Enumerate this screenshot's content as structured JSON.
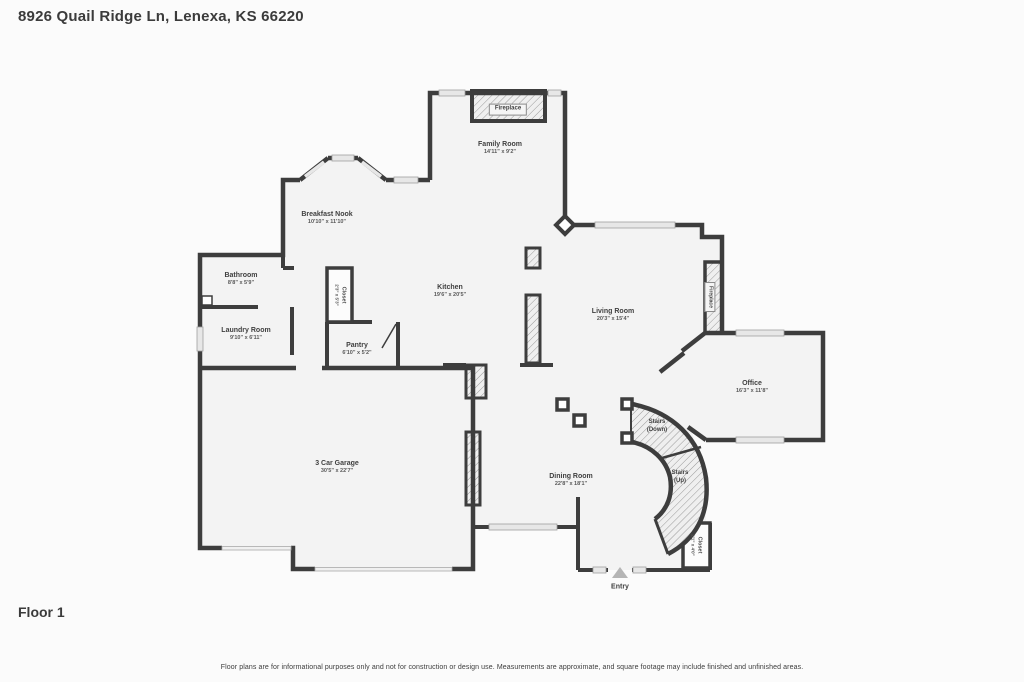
{
  "page": {
    "title": "8926 Quail Ridge Ln, Lenexa, KS 66220",
    "floor_label": "Floor 1",
    "disclaimer": "Floor plans are for informational purposes only and not for construction or design use. Measurements are approximate, and square footage may include finished and unfinished areas."
  },
  "colors": {
    "wall": "#3d3d3d",
    "room_fill": "#f3f3f3",
    "window_fill": "#e7e7e7",
    "background": "#fbfbfb"
  },
  "rooms": {
    "family_room": {
      "name": "Family Room",
      "dims": "14'11\" x 9'2\""
    },
    "breakfast_nook": {
      "name": "Breakfast Nook",
      "dims": "10'10\" x 11'10\""
    },
    "bathroom": {
      "name": "Bathroom",
      "dims": "8'8\" x 5'9\""
    },
    "laundry_room": {
      "name": "Laundry Room",
      "dims": "9'10\" x 6'11\""
    },
    "closet_kitchen": {
      "name": "Closet",
      "dims": "2'3\" x 5'3\""
    },
    "pantry": {
      "name": "Pantry",
      "dims": "6'10\" x 5'2\""
    },
    "kitchen": {
      "name": "Kitchen",
      "dims": "19'6\" x 20'5\""
    },
    "living_room": {
      "name": "Living Room",
      "dims": "20'3\" x 15'4\""
    },
    "office": {
      "name": "Office",
      "dims": "16'3\" x 11'8\""
    },
    "stairs_down": {
      "name": "Stairs",
      "sub": "(Down)"
    },
    "stairs_up": {
      "name": "Stairs",
      "sub": "(Up)"
    },
    "dining_room": {
      "name": "Dining Room",
      "dims": "22'8\" x 18'1\""
    },
    "garage": {
      "name": "3 Car Garage",
      "dims": "30'5\" x 22'7\""
    },
    "closet_entry": {
      "name": "Closet",
      "dims": "2'1\" x 4'0\""
    },
    "entry": {
      "name": "Entry"
    },
    "fireplace_family": {
      "name": "Fireplace"
    },
    "fireplace_living": {
      "name": "Fireplace"
    }
  }
}
